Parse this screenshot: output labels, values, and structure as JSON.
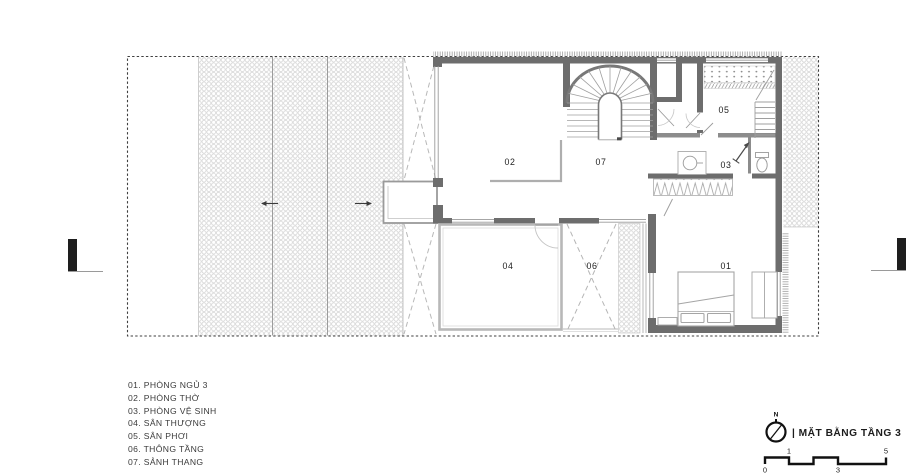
{
  "colors": {
    "wall": "#6d6d6d",
    "wall_light": "#b5b5b5",
    "thin_line": "#a3a3a3",
    "hatch": "#c9c9c9",
    "boundary_dash": "#3f3f3f",
    "text": "#3b3b3b",
    "marker_black": "#1e1e1e"
  },
  "rooms": [
    {
      "num": "01",
      "name": "PHÒNG NGỦ 3"
    },
    {
      "num": "02",
      "name": "PHÒNG THỜ"
    },
    {
      "num": "03",
      "name": "PHÒNG VỆ SINH"
    },
    {
      "num": "04",
      "name": "SÂN THƯỢNG"
    },
    {
      "num": "05",
      "name": "SÂN PHƠI"
    },
    {
      "num": "06",
      "name": "THÔNG TẦNG"
    },
    {
      "num": "07",
      "name": "SẢNH THANG"
    }
  ],
  "legend": {
    "items": [
      "01. PHÒNG NGỦ 3",
      "02. PHÒNG THỜ",
      "03. PHÒNG VỆ SINH",
      "04. SÂN THƯỢNG",
      "05. SÂN PHƠI",
      "06. THÔNG TẦNG",
      "07. SẢNH THANG"
    ]
  },
  "titleblock": {
    "north_label": "N",
    "title": "| MẶT BẰNG TẦNG 3",
    "scale_ticks": [
      "0",
      "1",
      "3",
      "5"
    ]
  }
}
